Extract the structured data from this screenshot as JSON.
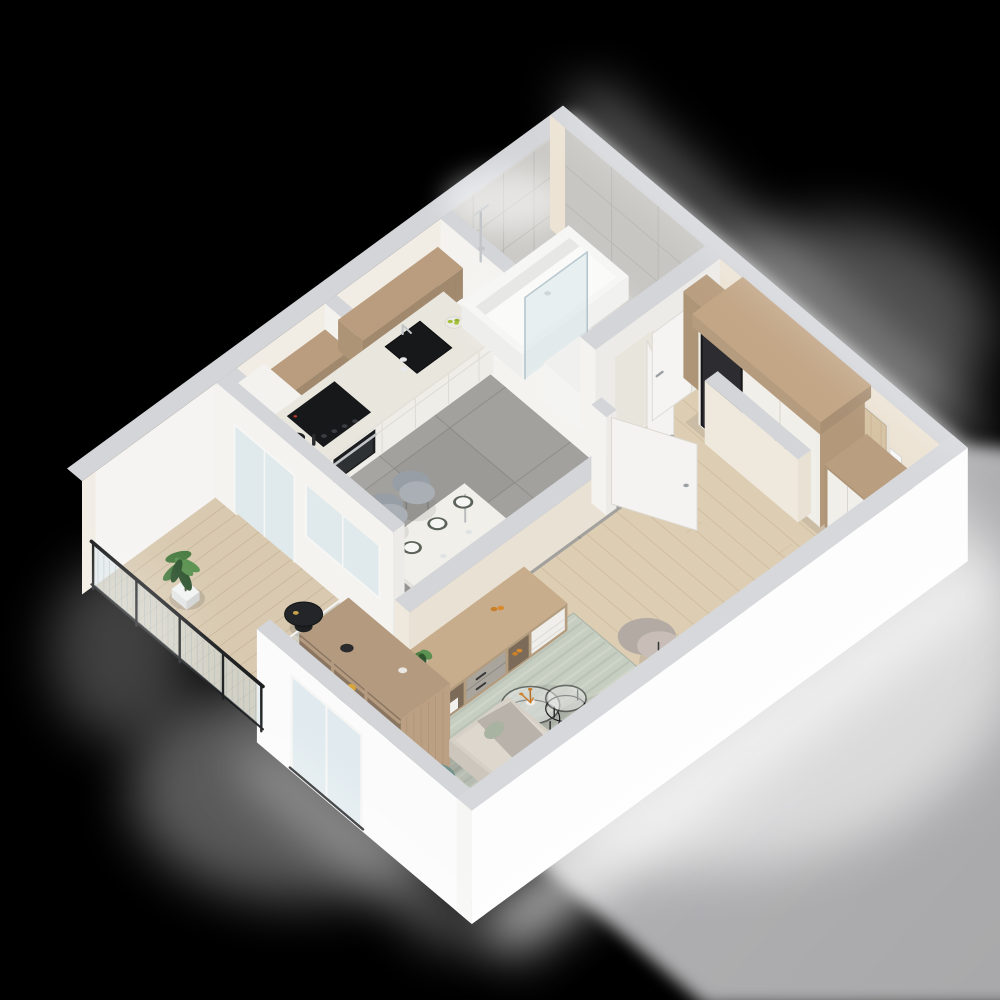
{
  "meta": {
    "description": "3D isometric render of a studio apartment floor plan on a black background: kitchen with wood upper cabinets, dining table, bathroom with tub and glass shower screen, hallway with mirrored wardrobe and wood entry door, living room with beige sofa, green and orange pillows, striped rug, round nesting coffee tables, wood bookshelf room divider, sideboard, work desk with teal chair, and a balcony with glass railing, plant and black side table.",
    "image_type": "architectural-3d-floorplan-render"
  },
  "rooms": [
    {
      "name": "kitchen"
    },
    {
      "name": "dining-area"
    },
    {
      "name": "bathroom"
    },
    {
      "name": "hallway"
    },
    {
      "name": "living-room"
    },
    {
      "name": "work-corner"
    },
    {
      "name": "balcony"
    }
  ],
  "furniture": [
    "kitchen-cabinets",
    "cooktop",
    "oven",
    "sink",
    "dining-table",
    "dining-chairs",
    "bathtub",
    "shower-screen",
    "washer-cabinet",
    "wardrobe-with-mirror",
    "wall-clock",
    "entry-door",
    "sideboard",
    "bookshelf-divider",
    "sofa",
    "coffee-tables",
    "area-rug",
    "armchair",
    "side-desk",
    "work-desk",
    "desk-chair",
    "laptop",
    "desk-lamp",
    "balcony-plant",
    "balcony-table",
    "glass-railing"
  ],
  "palette": {
    "background": "#000000",
    "backdrop_grey": "#b6b6b8",
    "backdrop_grey_dark": "#a8a8aa",
    "wall_top": "#d3d5d9",
    "wall_white": "#f4f3f0",
    "wall_bright": "#fbfbfb",
    "wall_warm": "#f2ede4",
    "wall_cream": "#ece3d4",
    "marble": "#cbcac6",
    "marble_line": "#b7b6b2",
    "tile_floor": "#a2a19d",
    "tile_line": "#8f8e8a",
    "wood_floor": "#ddcdb3",
    "wood_floor_line": "#cbb697",
    "deck": "#d8c9b0",
    "deck_line": "#c4b194",
    "cabinet_wood": "#b99d7e",
    "cabinet_wood_line": "#a1856a",
    "cabinet_white": "#efede8",
    "counter": "#e9e6de",
    "backsplash": "#756f60",
    "appliance_black": "#17181a",
    "steel": "#c2c5c8",
    "rug": "#c6cdc1",
    "rug_stripe": "#b3bbae",
    "rug_stripe_light": "#d8decf",
    "sofa": "#d7d0c6",
    "sofa_cushion": "#ded7cd",
    "pillow_orange": "#c9802b",
    "pillow_green": "#3c5339",
    "pillow_sage": "#a9b3a2",
    "pillow_grey": "#b9b4ac",
    "armchair": "#beb5ae",
    "chair_grey": "#a9afb5",
    "chair_teal": "#7fa79e",
    "desk_wood": "#cdb28e",
    "shelf_wood": "#b49a7e",
    "shelf_inner": "#8a7560",
    "sideboard_wood": "#c8ad8c",
    "sideboard_stone": "#a9a59d",
    "door_white": "#f4f3f1",
    "entry_door_wood": "#d6c3a4",
    "wardrobe_wood": "#b99e80",
    "mirror": "#2c2c31",
    "glass": "#ccdfe6",
    "railing_dark": "#1d1f21",
    "plant_green": "#4a7d42",
    "plant_green_dark": "#2f5530",
    "plant_green_light": "#5b9251",
    "accent_gold": "#c9a24b",
    "accent_yellow": "#d9a43a",
    "table_black": "#232528",
    "clock_wood": "#b89066",
    "grey_desk": "#a39e97"
  }
}
